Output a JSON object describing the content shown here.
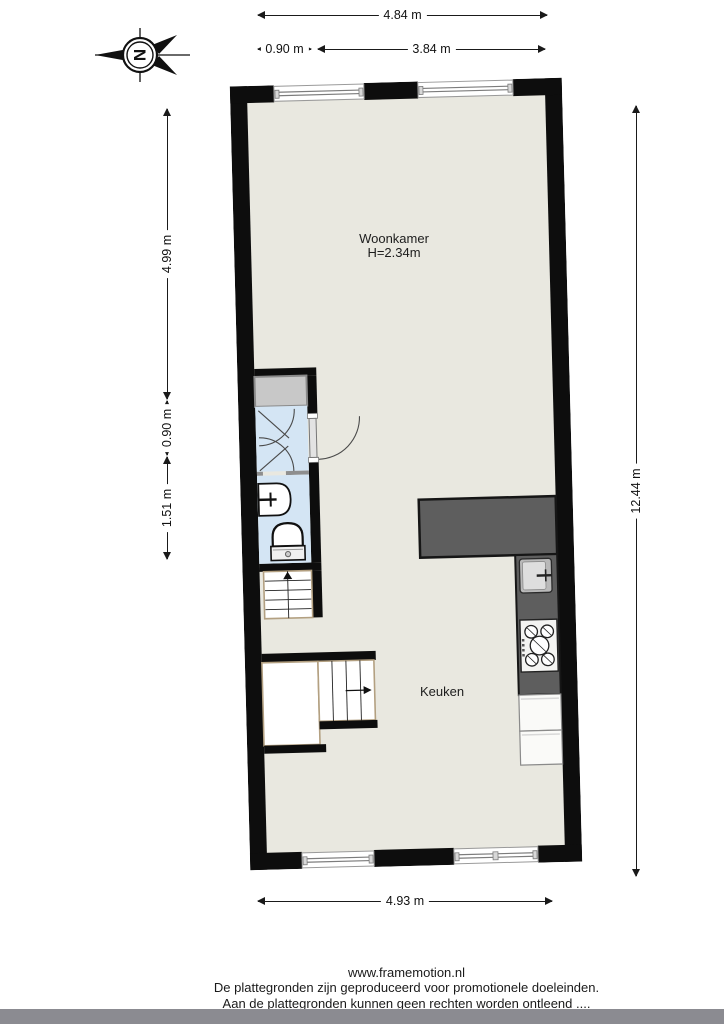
{
  "compass": {
    "letter": "N"
  },
  "plan": {
    "rooms": {
      "woonkamer": {
        "label": "Woonkamer",
        "height_label": "H=2.34m"
      },
      "keuken": {
        "label": "Keuken"
      }
    },
    "colors": {
      "wall": "#0d0d0d",
      "floor": "#e9e8e0",
      "wet_room": "#d4e5f4",
      "closet": "#c8c8c8",
      "kitchen_counter": "#5e5e5e",
      "stair_trim": "#b3a081"
    }
  },
  "dimensions": {
    "top_total": "4.84 m",
    "top_left": "0.90 m",
    "top_right": "3.84 m",
    "left_upper": "4.99 m",
    "left_middle": "0.90 m",
    "left_lower": "1.51 m",
    "right_total": "12.44 m",
    "bottom_total": "4.93 m"
  },
  "footer": {
    "website": "www.framemotion.nl",
    "disclaimer_line1": "De plattegronden zijn geproduceerd voor promotionele doeleinden.",
    "disclaimer_line2": "Aan de plattegronden kunnen geen rechten worden ontleend ...."
  }
}
